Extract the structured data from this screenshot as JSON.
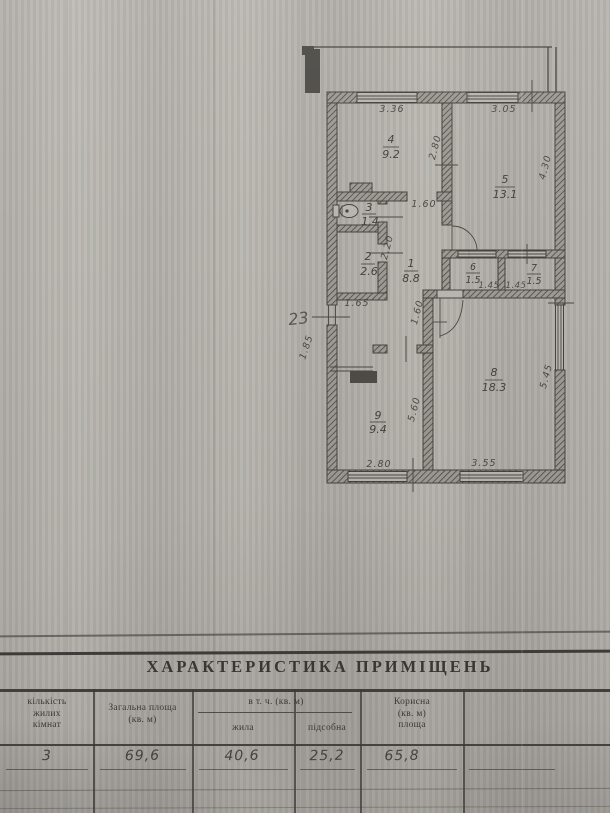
{
  "document": {
    "apartment_number": "23",
    "rooms": [
      {
        "num": "1",
        "area": "8.8"
      },
      {
        "num": "2",
        "area": "2.6"
      },
      {
        "num": "3",
        "area": "1.4"
      },
      {
        "num": "4",
        "area": "9.2"
      },
      {
        "num": "5",
        "area": "13.1"
      },
      {
        "num": "6",
        "area": "1.5"
      },
      {
        "num": "7",
        "area": "1.5"
      },
      {
        "num": "8",
        "area": "18.3"
      },
      {
        "num": "9",
        "area": "9.4"
      }
    ],
    "dimensions": {
      "top_wall_left": "3.36",
      "top_wall_right": "3.05",
      "room4_depth": "2.80",
      "room5_side": "4.30",
      "hall_top_door": "1.60",
      "room2_side": "2.20",
      "room2_width": "1.65",
      "room6_width": "1.45",
      "room7_width": "1.45",
      "entry_side": "1.85",
      "hall_passage": "1.60",
      "room9_side": "5.60",
      "room8_side": "5.45",
      "room9_width": "2.80",
      "room8_width": "3.55"
    },
    "table": {
      "title": "ХАРАКТЕРИСТИКА ПРИМІЩЕНЬ",
      "columns": {
        "rooms_count": [
          "кількість",
          "жилих",
          "кімнат"
        ],
        "total_area": [
          "Загальна площа",
          "(кв. м)"
        ],
        "including_group": "в т. ч. (кв. м)",
        "living": "жила",
        "auxiliary": "підсобна",
        "useful_area": [
          "Корисна",
          "(кв. м)",
          "площа"
        ]
      },
      "row": {
        "rooms_count": "3",
        "total_area": "69,6",
        "living": "40,6",
        "auxiliary": "25,2",
        "useful_area": "65,8"
      }
    }
  }
}
